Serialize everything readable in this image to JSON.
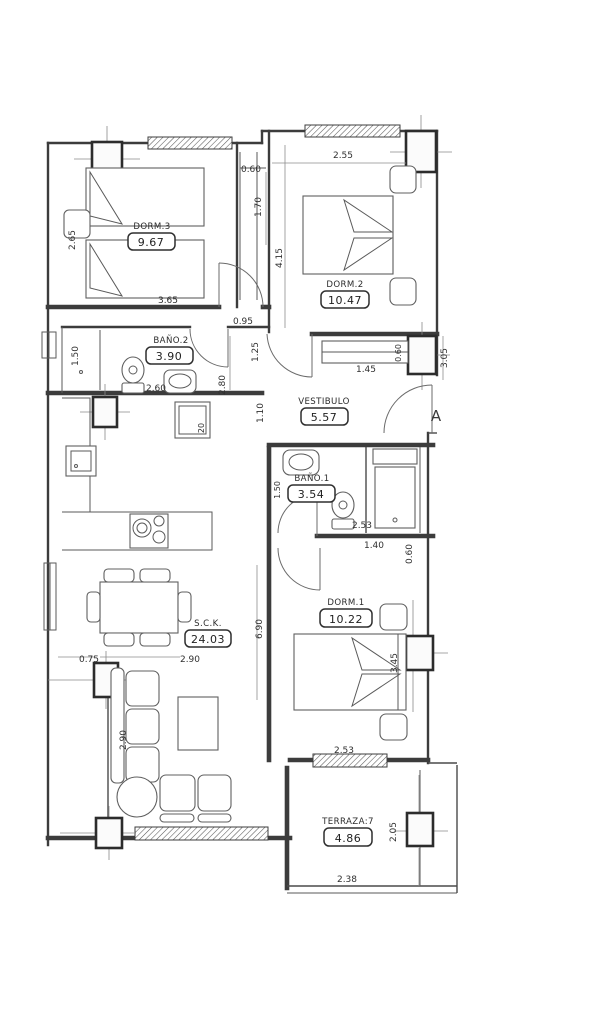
{
  "plan": {
    "colors": {
      "ink": "#3a3a3a",
      "paper": "#ffffff"
    },
    "rooms": {
      "dorm3": {
        "label": "DORM.3",
        "area": "9.67"
      },
      "dorm2": {
        "label": "DORM.2",
        "area": "10.47"
      },
      "bano2": {
        "label": "BAÑO.2",
        "area": "3.90"
      },
      "vestibulo": {
        "label": "VESTIBULO",
        "area": "5.57"
      },
      "bano1": {
        "label": "BAÑO.1",
        "area": "3.54"
      },
      "dorm1": {
        "label": "DORM.1",
        "area": "10.22"
      },
      "sck": {
        "label": "S.C.K.",
        "area": "24.03"
      },
      "terraza": {
        "label": "TERRAZA:7",
        "area": "4.86"
      }
    },
    "dims": {
      "niche_width": "0.60",
      "niche_height": "1.70",
      "dorm2_width": "2.55",
      "dorm3_bed": "2.65",
      "dorm3_width": "3.65",
      "dorm2_height": "4.15",
      "hall_width": "0.95",
      "hall_125": "1.25",
      "closet_left": "1.50",
      "bano2_width": "2.60",
      "bano2_height": "2.80",
      "vest_closet": "1.45",
      "vest_060": "0.60",
      "right_wall": "3.05",
      "vest_pass": "1.10",
      "bano1_left": "1.50",
      "bano1_width": "2.53",
      "bano1_140": "1.40",
      "shower_width": "0.60",
      "dorm1_height": "3.45",
      "dorm1_width": "2.53",
      "sck_height": "6.90",
      "sck_width": "2.90",
      "sck_offset": "0.75",
      "sofa_depth": "2.90",
      "appliance": "20",
      "terraza_height": "2.05",
      "terraza_width": "2.38"
    },
    "section_marker": "A"
  }
}
